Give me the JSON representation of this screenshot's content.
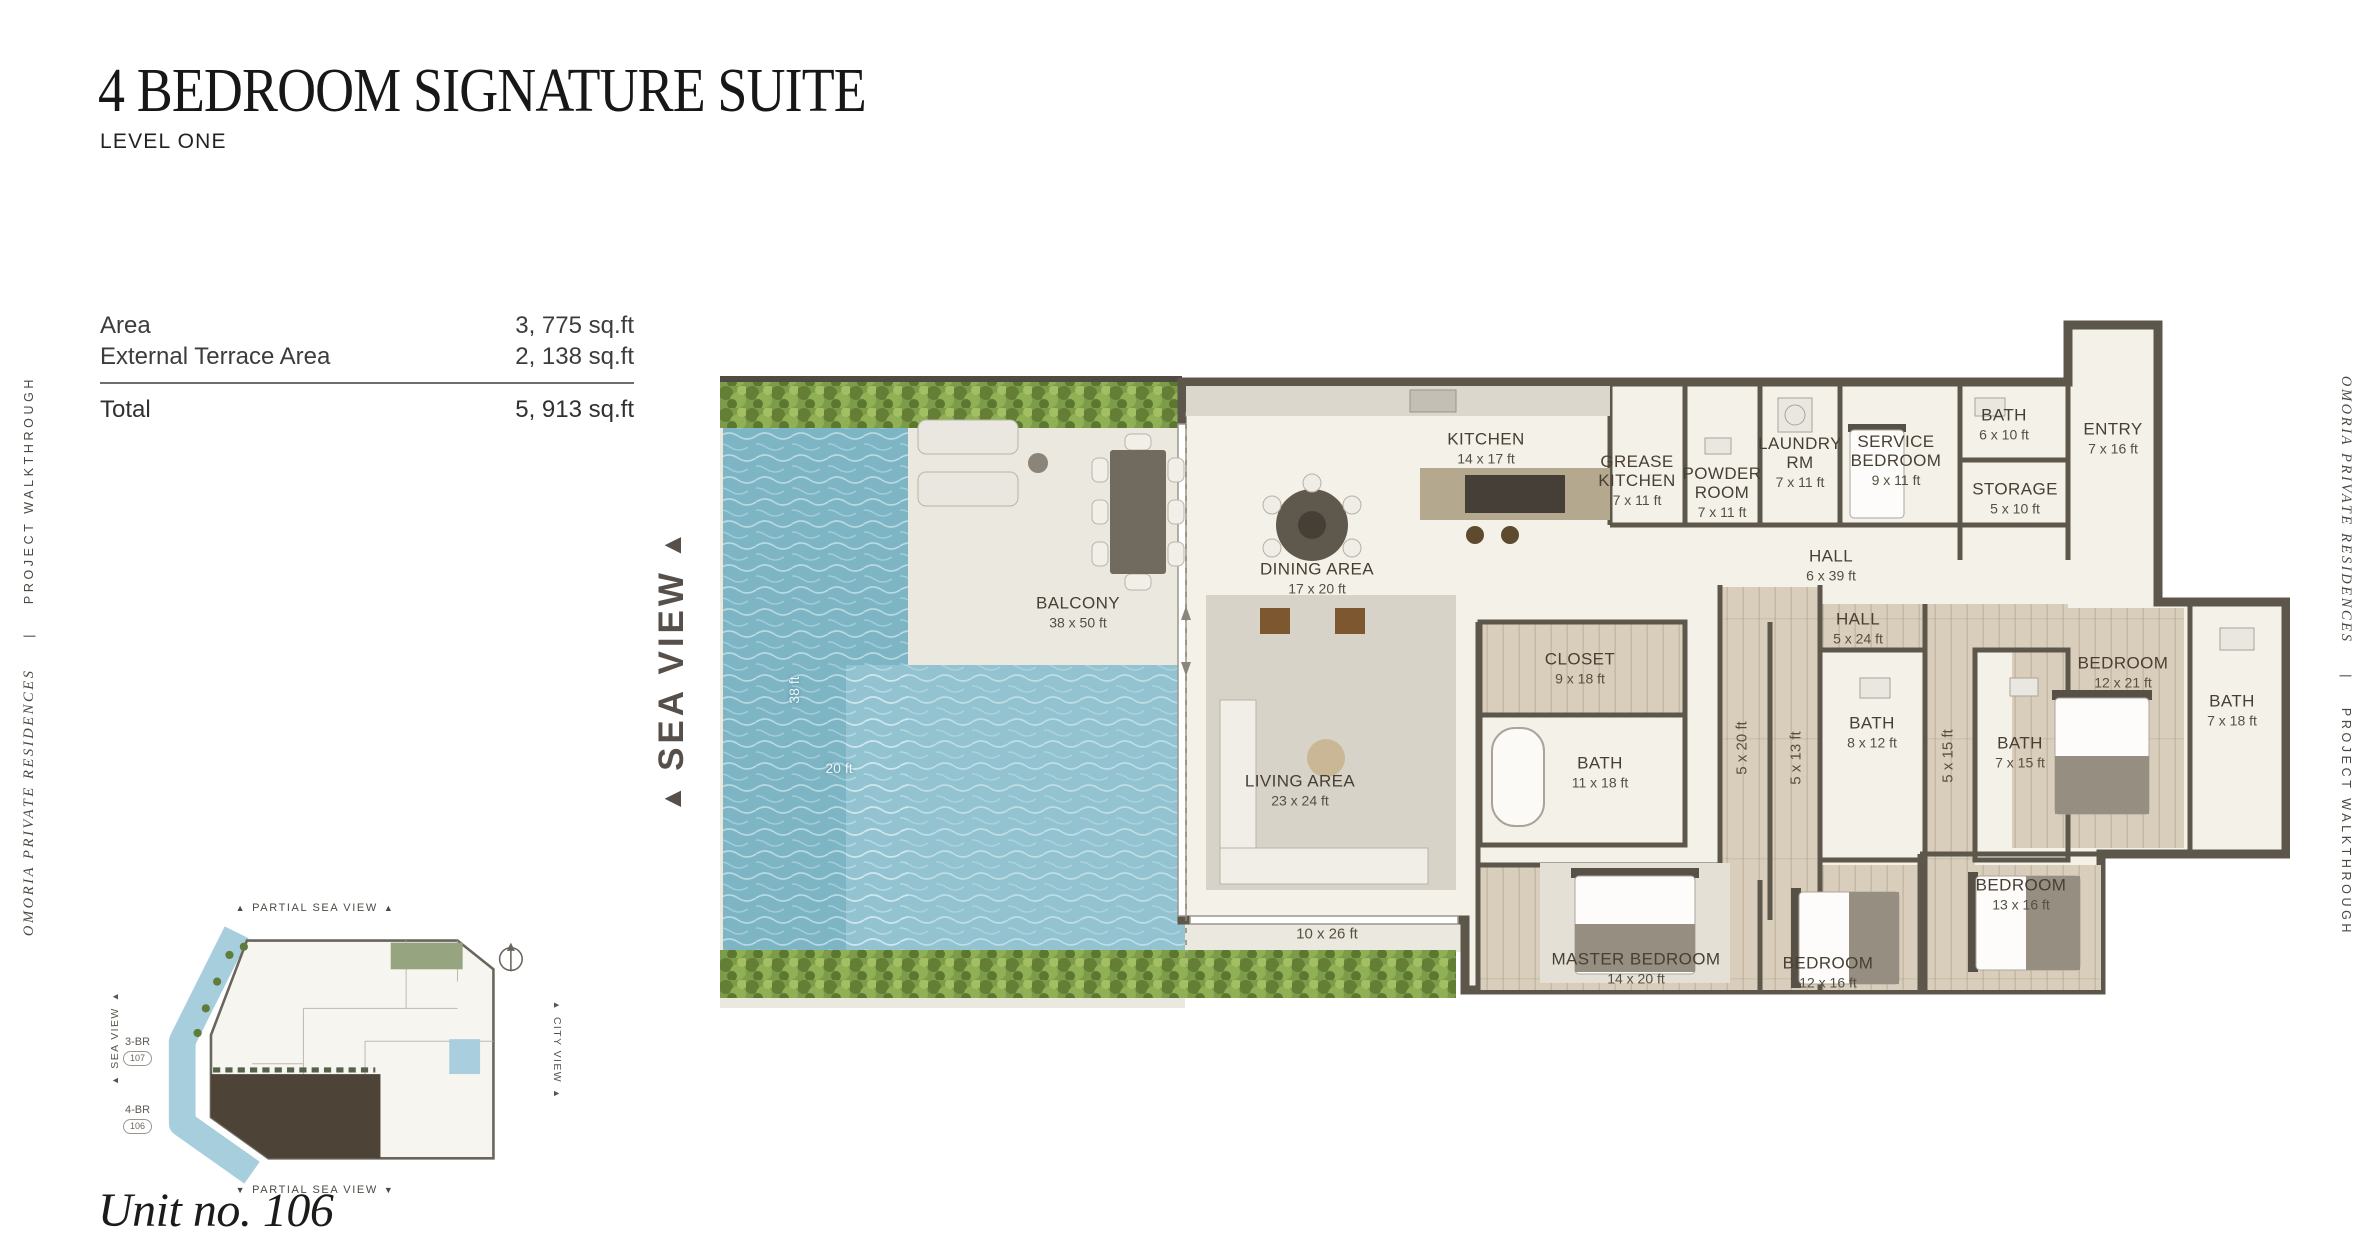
{
  "header": {
    "title": "4 BEDROOM SIGNATURE SUITE",
    "subtitle": "LEVEL ONE"
  },
  "area_table": {
    "rows": [
      {
        "label": "Area",
        "value": "3, 775 sq.ft"
      },
      {
        "label": "External Terrace Area",
        "value": "2, 138 sq.ft"
      }
    ],
    "total_label": "Total",
    "total_value": "5, 913 sq.ft"
  },
  "side_text": {
    "brand": "OMORIA PRIVATE RESIDENCES",
    "separator": "|",
    "tagline": "PROJECT WALKTHROUGH"
  },
  "sea_view_label": "SEA VIEW",
  "floorplan": {
    "rooms": [
      {
        "name": "KITCHEN",
        "dims": "14 x 17 ft"
      },
      {
        "name": "GREASE KITCHEN",
        "dims": "7 x 11 ft"
      },
      {
        "name": "POWDER ROOM",
        "dims": "7 x 11 ft"
      },
      {
        "name": "LAUNDRY RM",
        "dims": "7 x 11 ft"
      },
      {
        "name": "SERVICE BEDROOM",
        "dims": "9 x 11 ft"
      },
      {
        "name": "BATH",
        "dims": "6 x 10 ft"
      },
      {
        "name": "ENTRY",
        "dims": "7 x 16 ft"
      },
      {
        "name": "STORAGE",
        "dims": "5 x 10 ft"
      },
      {
        "name": "HALL",
        "dims": "6 x 39 ft"
      },
      {
        "name": "HALL",
        "dims": "5 x 24 ft"
      },
      {
        "name": "DINING AREA",
        "dims": "17 x 20 ft"
      },
      {
        "name": "BALCONY",
        "dims": "38 x 50 ft"
      },
      {
        "name": "CLOSET",
        "dims": "9 x 18 ft"
      },
      {
        "name": "BATH",
        "dims": "11 x 18 ft"
      },
      {
        "name": "LIVING AREA",
        "dims": "23 x 24 ft"
      },
      {
        "name": "BATH",
        "dims": "8 x 12 ft"
      },
      {
        "name": "BATH",
        "dims": "7 x 15 ft"
      },
      {
        "name": "BEDROOM",
        "dims": "12 x 21 ft"
      },
      {
        "name": "BATH",
        "dims": "7 x 18 ft"
      },
      {
        "name": "MASTER BEDROOM",
        "dims": "14 x 20 ft"
      },
      {
        "name": "BEDROOM",
        "dims": "12 x 16 ft"
      },
      {
        "name": "BEDROOM",
        "dims": "13 x 16 ft"
      }
    ],
    "corridor_dims": [
      "5 x 20 ft",
      "5 x 13 ft",
      "5 x 15 ft"
    ],
    "terrace_dim": "10 x 26 ft",
    "pool": {
      "length_label": "38 ft",
      "width_label": "20 ft"
    },
    "colors": {
      "wall": "#5d564b",
      "pool": "#7eb5c5",
      "hedge": "#7d9c49",
      "wood": "#d9cebc"
    }
  },
  "minimap": {
    "top_label": "PARTIAL SEA VIEW",
    "bottom_label": "PARTIAL SEA VIEW",
    "left_label": "SEA VIEW",
    "right_label": "CITY VIEW",
    "units": [
      {
        "type": "3-BR",
        "number": "107"
      },
      {
        "type": "4-BR",
        "number": "106"
      }
    ]
  },
  "unit_label": "Unit no. 106"
}
